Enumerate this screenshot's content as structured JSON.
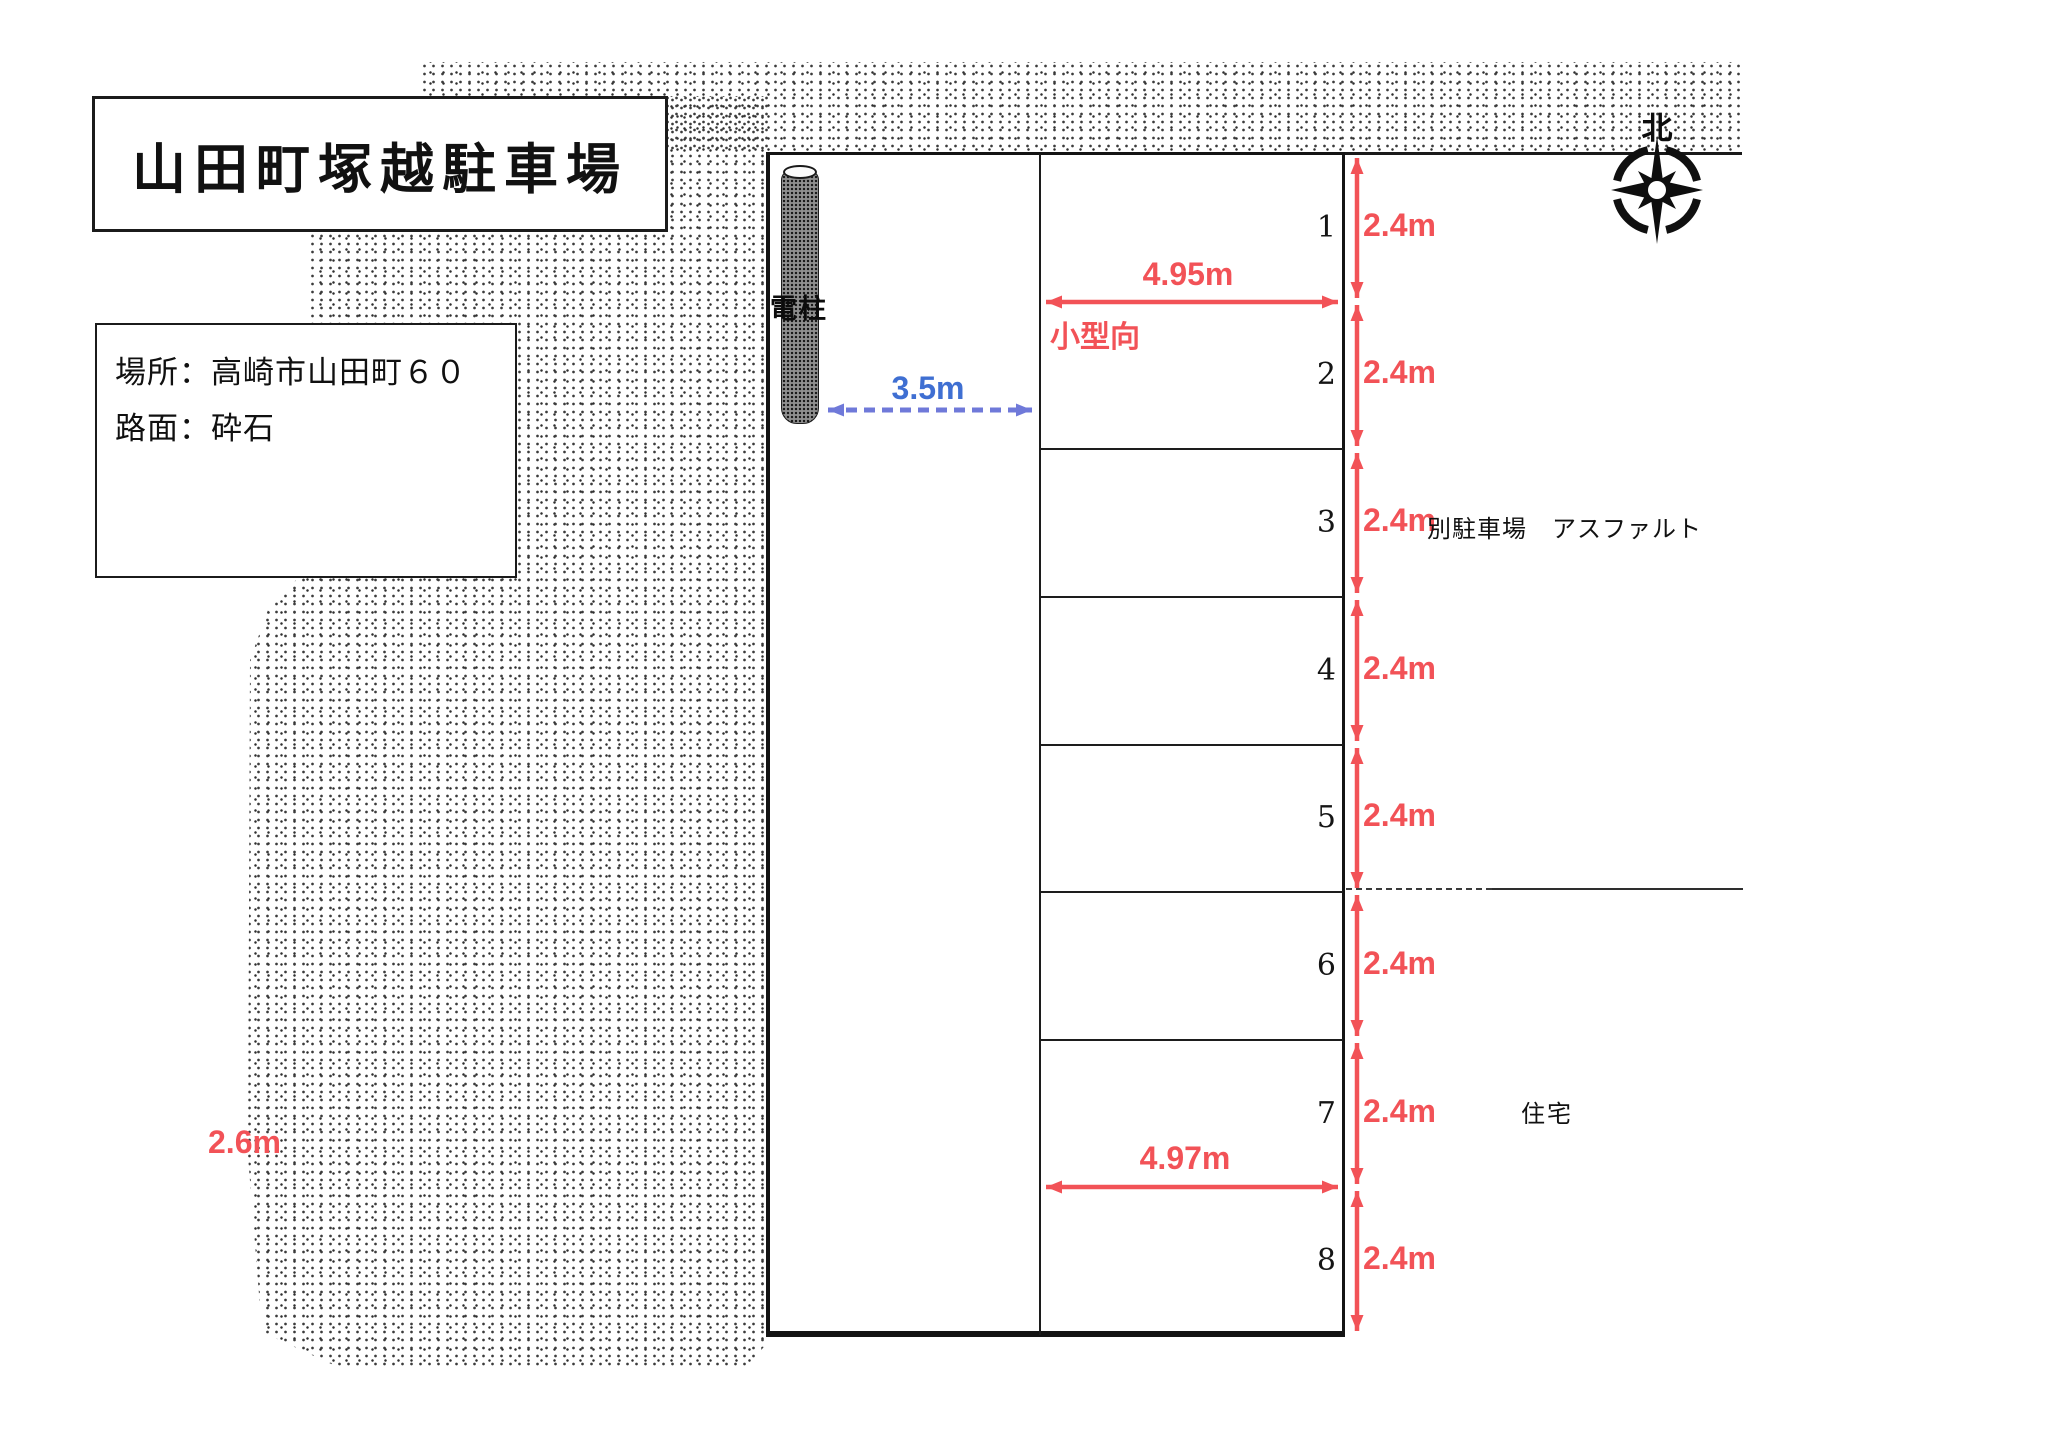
{
  "title": "山田町塚越駐車場",
  "info_box": {
    "location": "場所：高崎市山田町６０",
    "surface": "路面：砕石"
  },
  "compass": {
    "north_label": "北"
  },
  "pole": {
    "label": "電柱",
    "distance_label": "3.5m"
  },
  "stalls": [
    {
      "number": "1",
      "depth": "2.4m"
    },
    {
      "number": "2",
      "depth": "2.4m"
    },
    {
      "number": "3",
      "depth": "2.4m"
    },
    {
      "number": "4",
      "depth": "2.4m"
    },
    {
      "number": "5",
      "depth": "2.4m"
    },
    {
      "number": "6",
      "depth": "2.4m"
    },
    {
      "number": "7",
      "depth": "2.4m"
    },
    {
      "number": "8",
      "depth": "2.4m"
    }
  ],
  "dimensions": {
    "stall_width_top": "4.95m",
    "stall_width_bottom": "4.97m",
    "left_note": "2.6m",
    "stall_type_note": "小型向"
  },
  "surroundings": {
    "adjacent_parking": "別駐車場　アスファルト",
    "residence": "住宅"
  },
  "colors": {
    "dimension_red": "#f25257",
    "arrow_blue": "#6f79d9",
    "label_blue": "#3f6fd2",
    "ink": "#1a1a1a"
  }
}
